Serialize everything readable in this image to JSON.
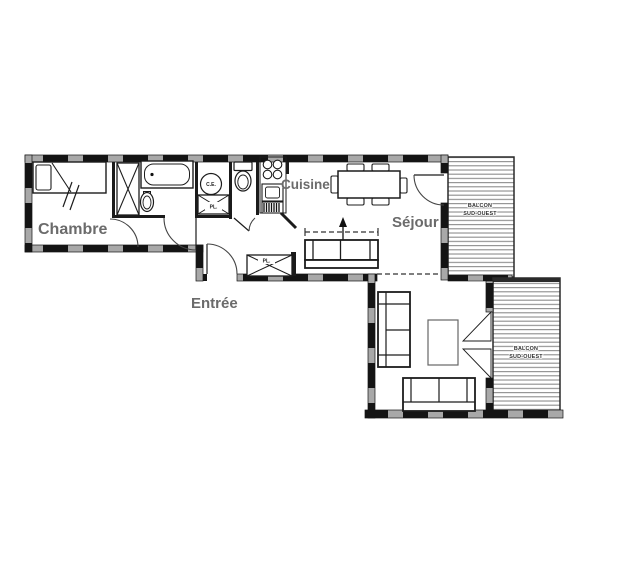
{
  "plan_title": "Apartment floor plan",
  "rooms": {
    "chambre": {
      "label": "Chambre"
    },
    "cuisine": {
      "label": "Cuisine"
    },
    "sejour": {
      "label": "Séjour"
    },
    "entree": {
      "label": "Entrée"
    }
  },
  "balconies": {
    "upper": {
      "line1": "BALCON",
      "line2": "SUD-OUEST"
    },
    "lower": {
      "line1": "BALCON",
      "line2": "SUD-OUEST"
    }
  },
  "fixtures": {
    "water_heater": {
      "label": "C.E."
    },
    "closet_bathroom": {
      "label": "PL."
    },
    "closet_entree": {
      "label": "PL."
    }
  },
  "colors": {
    "background": "#ffffff",
    "wall_black": "#141414",
    "wall_gap_gray": "#a8a8a8",
    "line_dark": "#1c1c1c",
    "label_gray": "#6b6b6b",
    "balcony_stripe": "#8c8c8c",
    "coffee_table_gray": "#666666"
  }
}
